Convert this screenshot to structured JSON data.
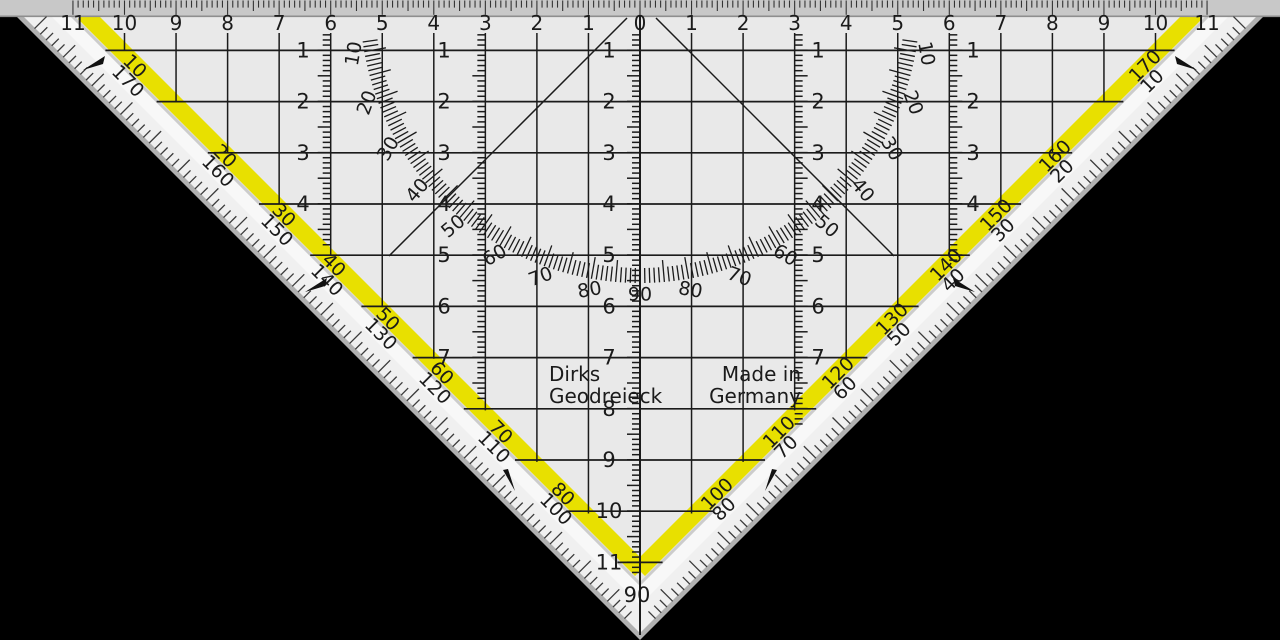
{
  "scene": "Geodreieck set square protractor on black background",
  "colors": {
    "background": "#000000",
    "strip": "#c8c8c8",
    "strip_border": "#8e8e8e",
    "rim": "#b0b0b0",
    "bevel_zone": "#f0f0f0",
    "white_zone": "#f8f8f8",
    "interior": "#e9e9e9",
    "crease": "#cccccc",
    "stripe_yellow": "#e8e000",
    "ink": "#1b1b1b",
    "tick_ink": "#333333"
  },
  "top_ruler": {
    "numbers": [
      11,
      10,
      9,
      8,
      7,
      6,
      5,
      4,
      3,
      2,
      1,
      0,
      1,
      2,
      3,
      4,
      5,
      6,
      7,
      8,
      9,
      10,
      11
    ]
  },
  "vertical_scales": {
    "center": {
      "labels": [
        1,
        2,
        3,
        4,
        5,
        6,
        7,
        8,
        9,
        10,
        11
      ],
      "apex_label": "90"
    },
    "left_inner": {
      "labels": [
        1,
        2,
        3,
        4,
        5,
        6,
        7
      ]
    },
    "left_outer": {
      "labels": [
        1,
        2,
        3,
        4
      ]
    },
    "right_inner": {
      "labels": [
        1,
        2,
        3,
        4,
        5,
        6,
        7
      ]
    },
    "right_outer": {
      "labels": [
        1,
        2,
        3,
        4
      ]
    }
  },
  "protractor": {
    "degree_labels": [
      10,
      20,
      30,
      40,
      50,
      60,
      70,
      80,
      90,
      80,
      70,
      60,
      50,
      40,
      30,
      20,
      10
    ],
    "start_deg": 10,
    "end_deg": 170,
    "label_step": 10
  },
  "edge_scales": {
    "left": {
      "on_stripe": [
        10,
        20,
        30,
        40,
        50,
        60,
        70,
        80
      ],
      "outside": [
        170,
        160,
        150,
        140,
        130,
        120,
        110,
        100
      ]
    },
    "right": {
      "on_stripe": [
        170,
        160,
        150,
        140,
        130,
        120,
        110,
        100
      ],
      "outside": [
        10,
        20,
        30,
        40,
        50,
        60,
        70,
        80
      ]
    }
  },
  "branding": {
    "line1": "Dirks",
    "line2": "Geodreieck"
  },
  "origin": {
    "line1": "Made in",
    "line2": "Germany"
  }
}
